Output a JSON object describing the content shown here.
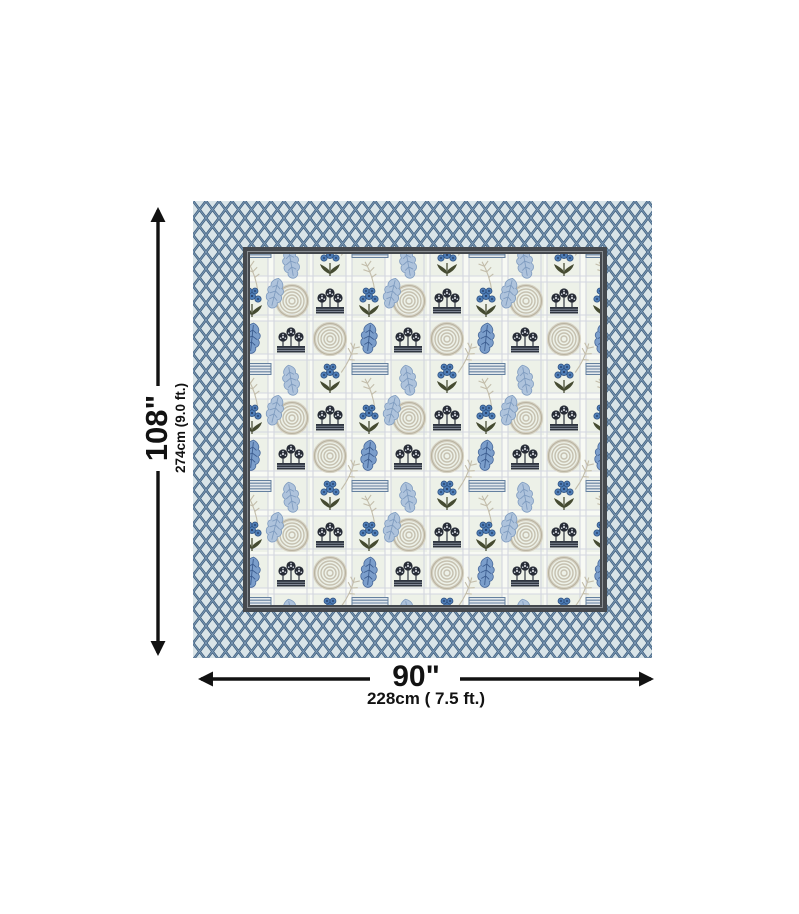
{
  "image": {
    "type": "product-dimension-diagram",
    "subject": "Double bedsheet with blue ogee-lattice border and botanical block-print inner panel"
  },
  "dimensions": {
    "height": {
      "label_inches": "108\"",
      "label_metric": "274cm (9.0 ft.)"
    },
    "width": {
      "label_inches": "90\"",
      "label_metric": "228cm ( 7.5 ft.)"
    }
  },
  "palette": {
    "canvas_bg": "#ffffff",
    "border_lattice_navy": "#41607f",
    "border_lattice_highlight": "#7e9cb8",
    "border_lattice_bg": "#d9e4e8",
    "inner_frame": "#45494e",
    "panel_bg": "#edf1e8",
    "plaid_line": "#d3d6df",
    "leaf_blue": "#7b9ecb",
    "leaf_blue_light": "#aec3dc",
    "floral_dark": "#2f3540",
    "flower_blue": "#4d7cb5",
    "leaf_olive": "#454b31",
    "spiral_beige": "#c6c1b0",
    "wheat_beige": "#c3bdaa",
    "stripe_bar_blue": "#64809f",
    "arrow": "#121212"
  }
}
